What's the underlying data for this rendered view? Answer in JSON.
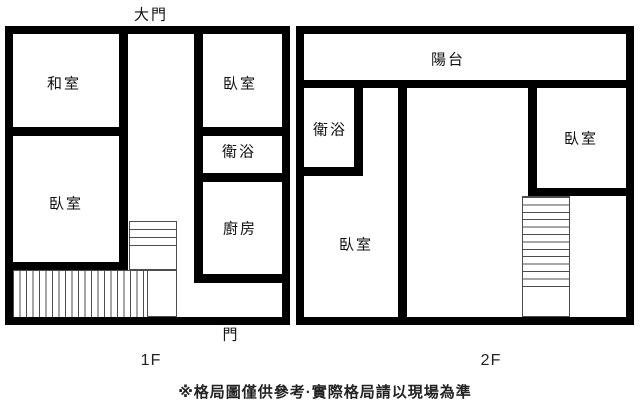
{
  "floor1": {
    "name": "1F",
    "entrance_label": "大門",
    "door_label": "門",
    "rooms": {
      "tatami": "和室",
      "bedroom_upper": "臥室",
      "bedroom_lower": "臥室",
      "bath": "衛浴",
      "kitchen": "廚房"
    }
  },
  "floor2": {
    "name": "2F",
    "rooms": {
      "balcony": "陽台",
      "bath": "衛浴",
      "bedroom_left": "臥室",
      "bedroom_right": "臥室"
    }
  },
  "footer_note": "※格局圖僅供參考·實際格局請以現場為準",
  "colors": {
    "wall": "#000000",
    "background": "#ffffff",
    "stair_line": "#4d4d4d"
  }
}
